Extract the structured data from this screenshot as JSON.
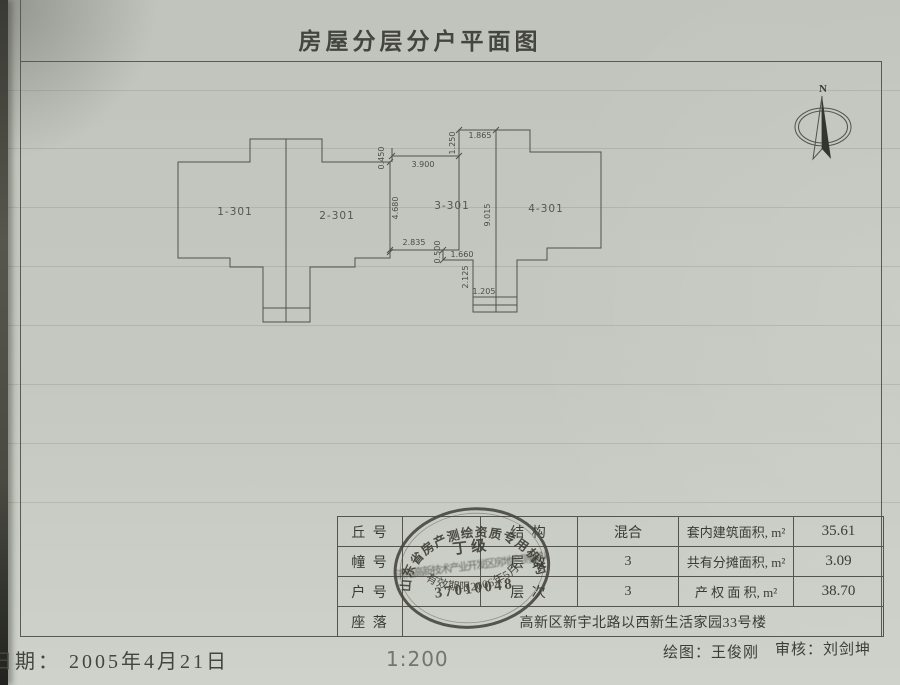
{
  "title": "房屋分层分户平面图",
  "colors": {
    "paper": "#c4c8c0",
    "ink": "#3b3b36",
    "line": "#54544c",
    "stamp": "#3a3a33"
  },
  "plan": {
    "north_label": "N",
    "units": {
      "u1": "1-301",
      "u2": "2-301",
      "u3": "3-301",
      "u4": "4-301"
    },
    "dimensions": {
      "left_offset": "0.450",
      "top_gap": "3.900",
      "notch_top": "1.250",
      "top_width": "1.865",
      "left_wall": "4.680",
      "party_wall": "9.015",
      "bottom_gap": "2.835",
      "notch_small": "0.500",
      "bottom_w1": "1.660",
      "bottom_h1": "2.125",
      "bottom_w2": "1.205"
    }
  },
  "table": {
    "rows": [
      {
        "label": "丘 号",
        "mid_label": "结 构",
        "mid_value": "混合",
        "area_label": "套内建筑面积, m²",
        "area_value": "35.61"
      },
      {
        "label": "幢 号",
        "mid_label": "层 数",
        "mid_value": "3",
        "area_label": "共有分摊面积, m²",
        "area_value": "3.09"
      },
      {
        "label": "户 号",
        "mid_label": "层 次",
        "mid_value": "3",
        "area_label": "产 权 面 积, m²",
        "area_value": "38.70"
      }
    ],
    "address_label": "座 落",
    "address_value": "高新区新宇北路以西新生活家园33号楼"
  },
  "stamp": {
    "arc_top": "山东省房产测绘资质专用机构",
    "grade": "丁 级",
    "org_line": "济南高新技术产业开发区房地产测绘队",
    "number": "37010048",
    "arc_bottom": "有效期限2006年5月"
  },
  "footer": {
    "date": "日期： 2005年4月21日",
    "scale": "1:200",
    "drafter": "绘图：王俊刚",
    "reviewer": "审核：刘剑坤"
  }
}
